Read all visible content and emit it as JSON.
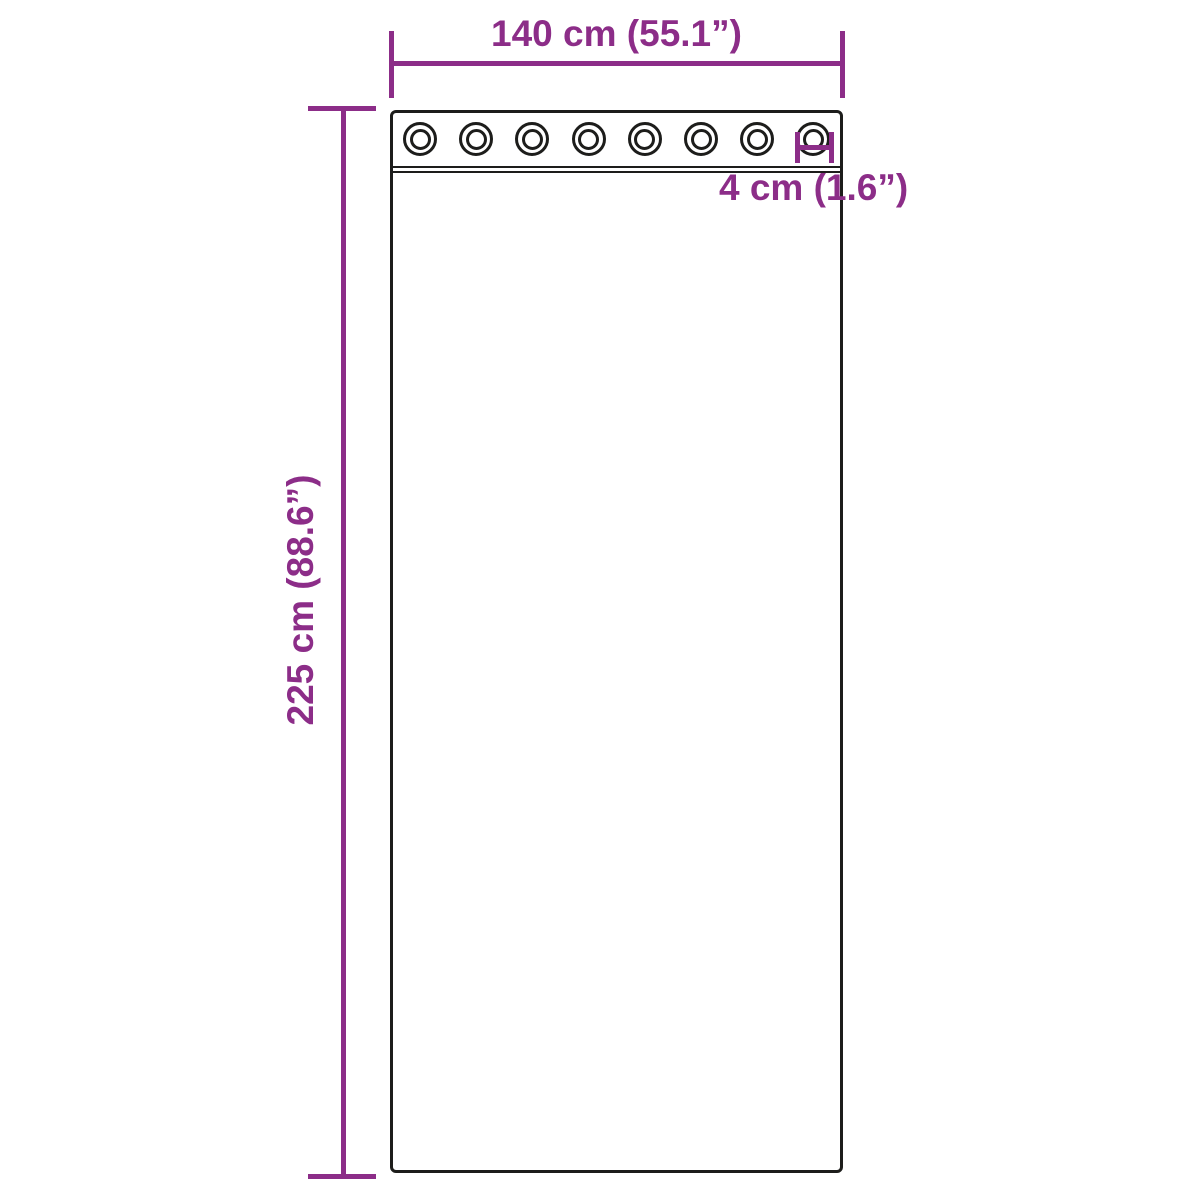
{
  "diagram": {
    "type": "product-dimension-diagram",
    "subject": "curtain panel with grommets",
    "dimensions": {
      "width": {
        "label": "140 cm (55.1”)",
        "value_cm": 140,
        "value_in": 55.1
      },
      "height": {
        "label": "225 cm (88.6”)",
        "value_cm": 225,
        "value_in": 88.6
      },
      "grommet": {
        "label": "4 cm (1.6”)",
        "value_cm": 4,
        "value_in": 1.6
      }
    },
    "grommets": {
      "count": 8
    },
    "colors": {
      "accent": "#8c2d88",
      "ink": "#1d1d1b",
      "background": "#ffffff"
    }
  }
}
